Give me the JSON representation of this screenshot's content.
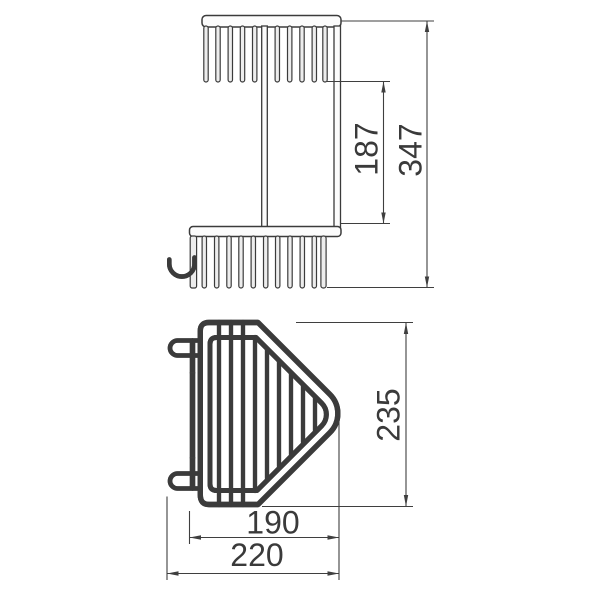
{
  "canvas": {
    "background": "#ffffff",
    "line_color": "#3b3b3b",
    "fill_light": "#ededed"
  },
  "front_view": {
    "dim_tier_spacing": "187",
    "dim_overall_height": "347"
  },
  "plan_view": {
    "dim_depth": "235",
    "dim_basket_width": "190",
    "dim_overall_width": "220"
  }
}
